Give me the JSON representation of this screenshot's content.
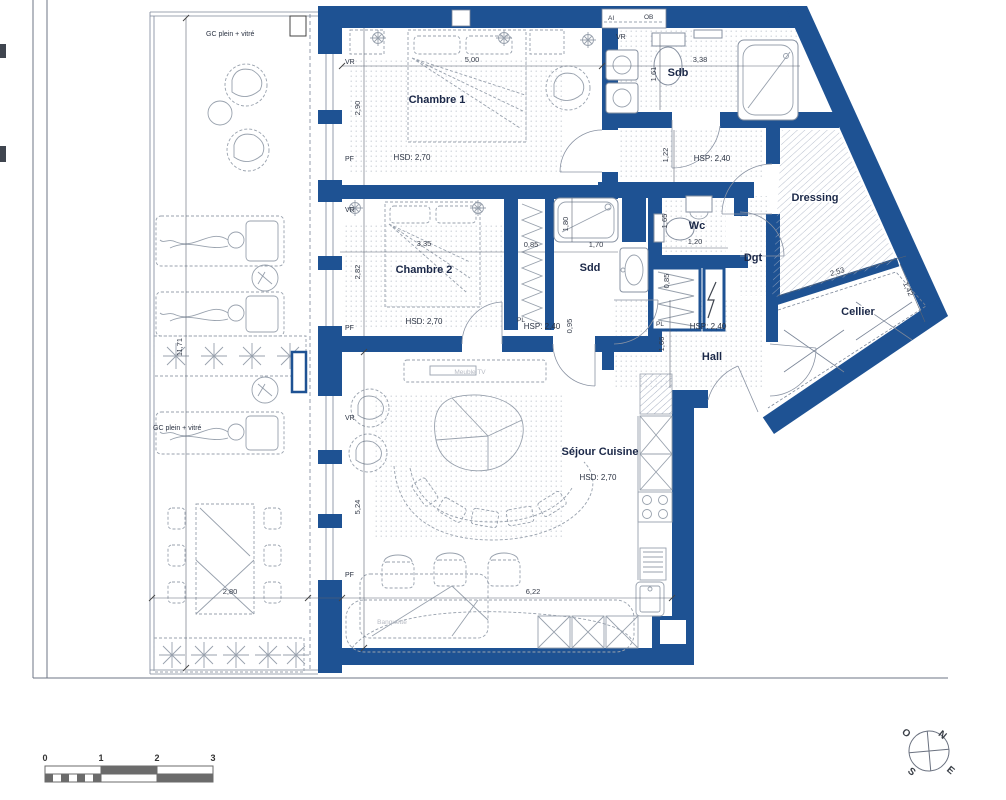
{
  "rooms": {
    "chambre1": {
      "name": "Chambre 1",
      "ceiling": "HSD: 2,70"
    },
    "chambre2": {
      "name": "Chambre 2",
      "ceiling": "HSD: 2,70"
    },
    "sejour": {
      "name": "Séjour Cuisine",
      "ceiling": "HSD: 2,70"
    },
    "sdb": {
      "name": "Sdb"
    },
    "sdd": {
      "name": "Sdd"
    },
    "wc": {
      "name": "Wc"
    },
    "dgt": {
      "name": "Dgt"
    },
    "dressing": {
      "name": "Dressing"
    },
    "cellier": {
      "name": "Cellier"
    },
    "hall": {
      "name": "Hall",
      "ceiling": "HSP: 2,40"
    },
    "corridor": {
      "ceiling": "HSP: 2,40"
    },
    "sdd_zone": {
      "ceiling": "HSP: 2,40"
    }
  },
  "closets": {
    "pl": "PL"
  },
  "shaft": {
    "ai": "AI",
    "ob": "OB"
  },
  "windows": {
    "vr": "VR",
    "pf": "PF"
  },
  "balcony": {
    "gc_note": "GC plein + vitré"
  },
  "furniture_notes": {
    "tv": "Meuble TV",
    "banquette": "Banquette"
  },
  "dims": {
    "ch1_w": "5,00",
    "ch1_d": "2,90",
    "sdb_w": "3,38",
    "sdb_d": "1,61",
    "ch2_w": "3,35",
    "ch2_d": "2,82",
    "pl1_w": "0,85",
    "shower_w": "1,70",
    "shower_d": "1,80",
    "sdd_door": "0,95",
    "wc_w": "1,20",
    "wc_d": "1,65",
    "pl2_w": "0,85",
    "corr_w": "1,22",
    "hall_w": "1,66",
    "cellier_w": "2,53",
    "cellier_d": "1,42",
    "sejour_d": "5,24",
    "sejour_w": "6,22",
    "balcony_l": "11,71",
    "balcony_w": "2,80"
  },
  "scale_bar": {
    "t0": "0",
    "t1": "1",
    "t2": "2",
    "t3": "3"
  },
  "compass": {
    "n": "N",
    "e": "E",
    "s": "S",
    "o": "O"
  },
  "colors": {
    "wall": "#1e5293",
    "drawing_line": "#7b8698",
    "furniture_line": "#98a1ad",
    "label": "#1b2848",
    "faint_label": "#b7bbc4",
    "scale_dark": "#6b6b6b"
  }
}
